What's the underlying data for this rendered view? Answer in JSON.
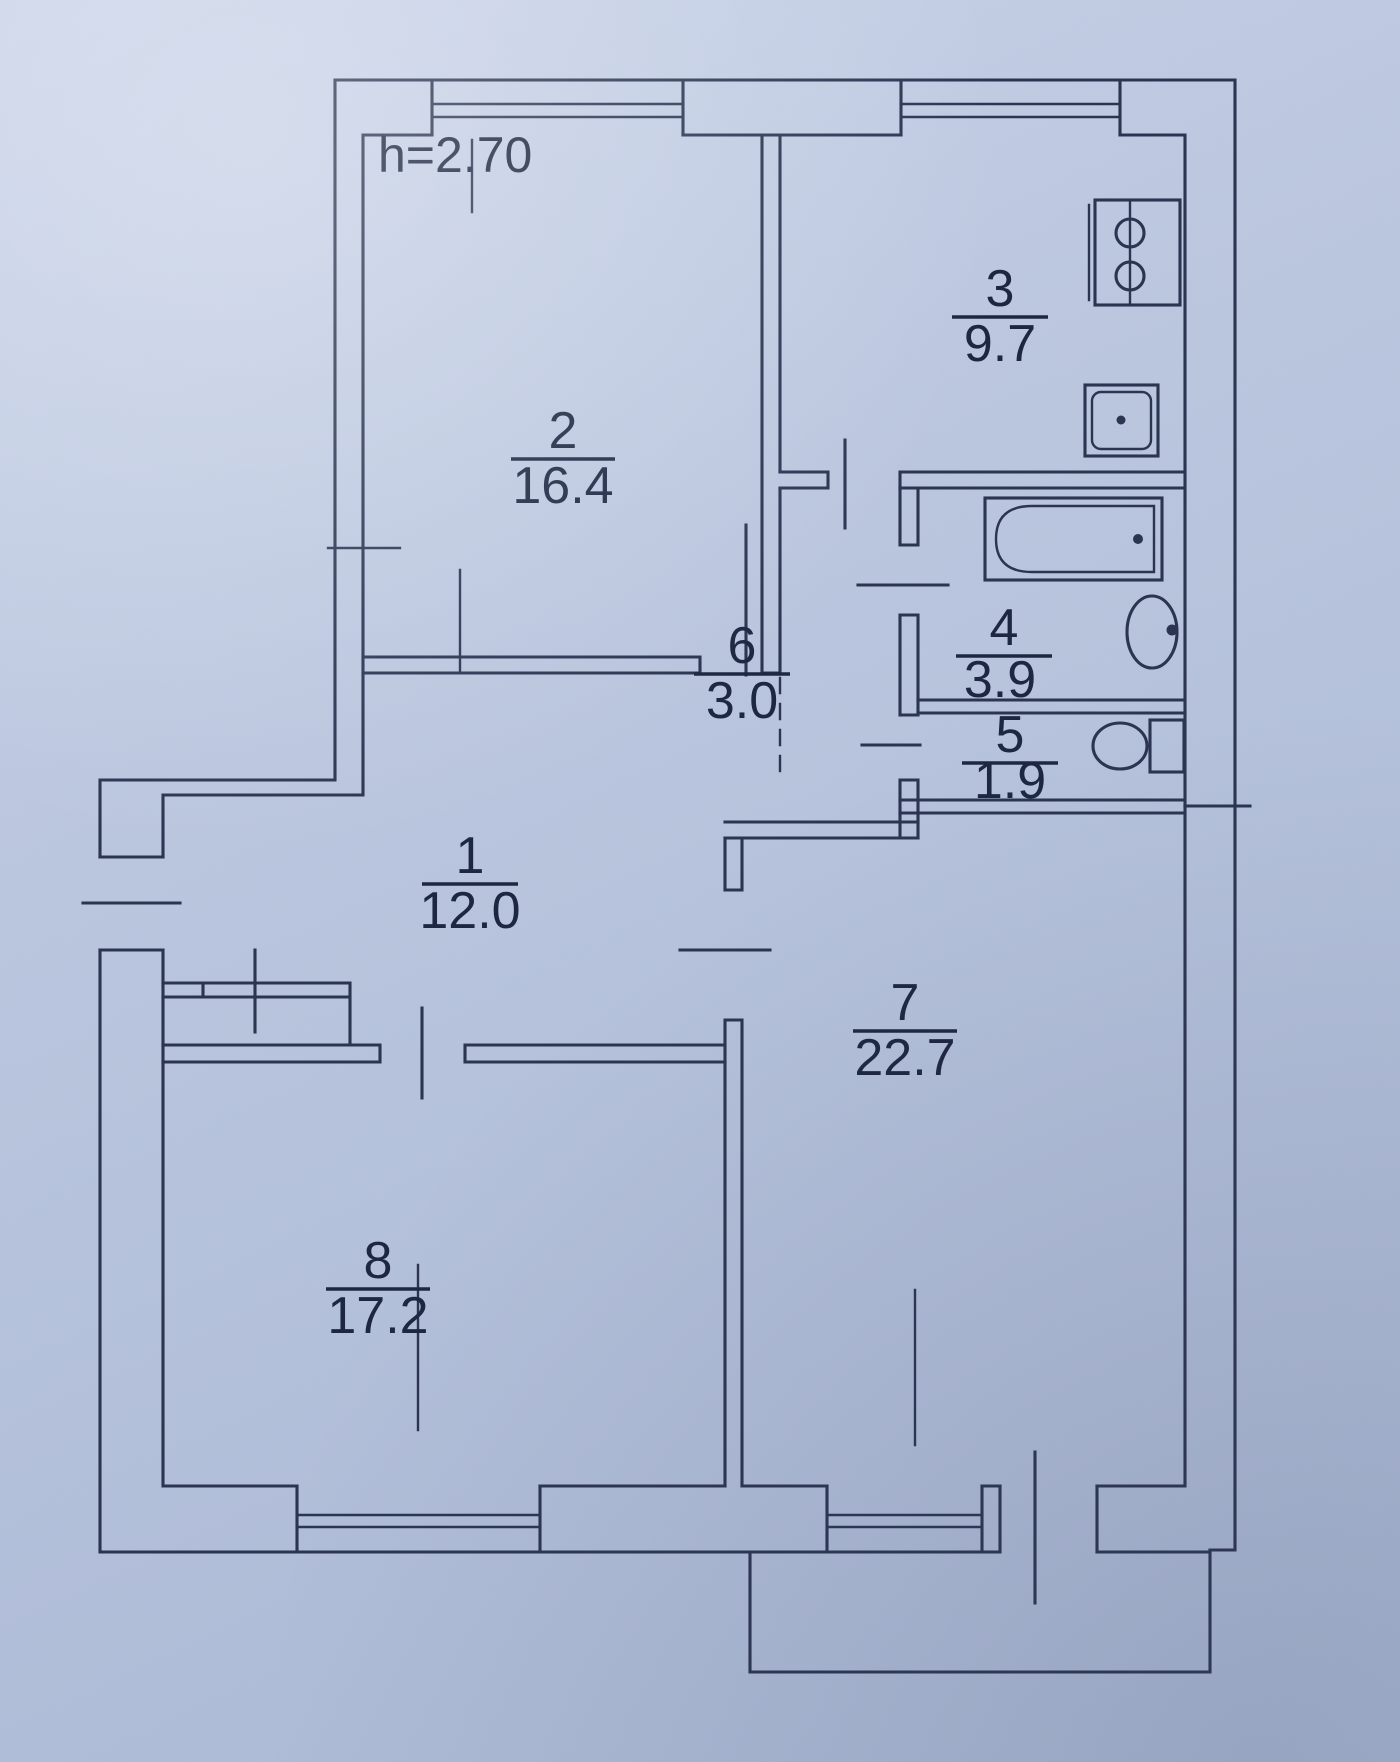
{
  "title": "Apartment floor plan (scanned technical passport drawing)",
  "ceiling_height_label": "h=2.70",
  "rooms": [
    {
      "number": "1",
      "area": "12.0",
      "kind": "hallway"
    },
    {
      "number": "2",
      "area": "16.4",
      "kind": "living-room"
    },
    {
      "number": "3",
      "area": "9.7",
      "kind": "kitchen"
    },
    {
      "number": "4",
      "area": "3.9",
      "kind": "bathroom"
    },
    {
      "number": "5",
      "area": "1.9",
      "kind": "wc"
    },
    {
      "number": "6",
      "area": "3.0",
      "kind": "corridor"
    },
    {
      "number": "7",
      "area": "22.7",
      "kind": "living-room"
    },
    {
      "number": "8",
      "area": "17.2",
      "kind": "living-room"
    }
  ],
  "fixtures": [
    "stove-icon",
    "kitchen-sink-icon",
    "bathtub-icon",
    "washbasin-icon",
    "toilet-icon",
    "wardrobe",
    "entrance-door",
    "balcony",
    "window"
  ],
  "colors": {
    "paper_light": "#cbd5ea",
    "paper_dark": "#a9b7d4",
    "ink": "#2b3552",
    "text_ink": "#1d2742"
  }
}
